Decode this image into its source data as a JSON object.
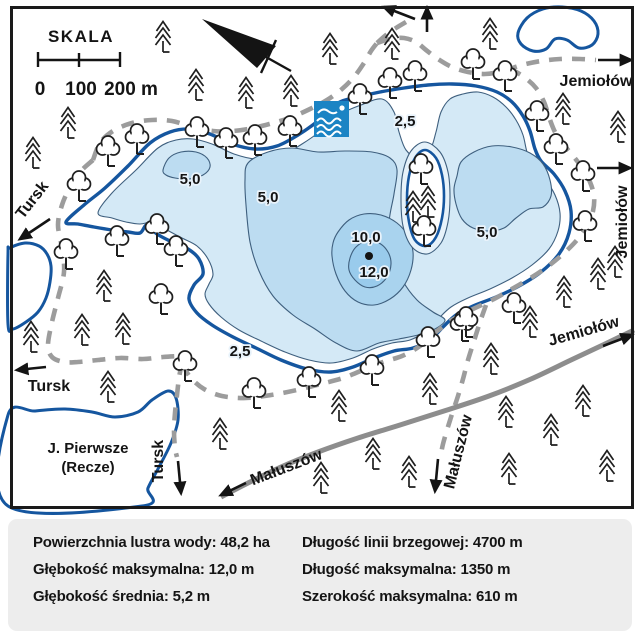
{
  "scale_bar": {
    "title": "SKALA",
    "ticks": [
      "0",
      "100",
      "200 m"
    ]
  },
  "road_labels": {
    "jemiolow_top": "Jemiołów",
    "jemiolow_east": "Jemiołów",
    "jemiolow_southeast": "Jemiołów",
    "tursk_northwest": "Tursk",
    "tursk_west": "Tursk",
    "tursk_south": "Tursk",
    "maluszow_solid_road": "Małuszów",
    "maluszow_path": "Małuszów"
  },
  "lakes": {
    "side_lake_name_line1": "J. Pierwsze",
    "side_lake_name_line2": "(Recze)"
  },
  "depth_labels": {
    "north_2_5": "2,5",
    "south_2_5": "2,5",
    "west_5": "5,0",
    "center_5": "5,0",
    "east_5": "5,0",
    "max_10": "10,0",
    "max_12": "12,0"
  },
  "stats_panel": {
    "left_column": [
      "Powierzchnia lustra wody: 48,2 ha",
      "Głębokość maksymalna: 12,0 m",
      "Głębokość średnia: 5,2 m"
    ],
    "right_column": [
      "Długość linii brzegowej: 4700 m",
      "Długość maksymalna: 1350 m",
      "Szerokość maksymalna: 610 m"
    ]
  },
  "colors": {
    "shore": "#15569f",
    "contour": "#3e5f7e",
    "water_0": "#e6f2fa",
    "water_2_5": "#d4e9f6",
    "water_5": "#bcdcf1",
    "water_10": "#a9d3ee",
    "water_12": "#99cbec",
    "road_dashed": "#9c9c9c",
    "road_solid": "#8d8d8d",
    "swim_icon_bg": "#1b84c4",
    "panel_bg": "#ededed"
  }
}
